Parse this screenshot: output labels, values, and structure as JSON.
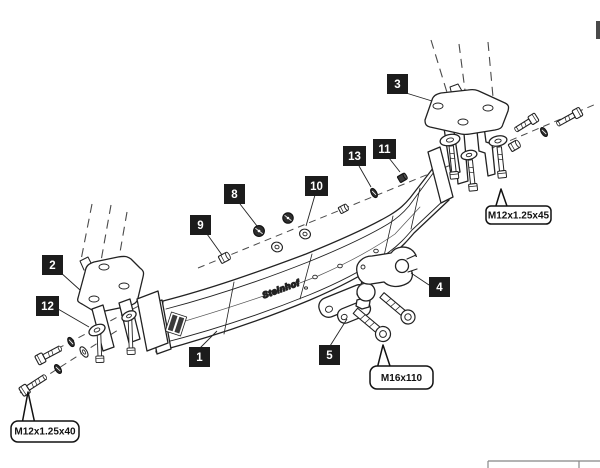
{
  "diagram": {
    "kind": "towbar-exploded-assembly-drawing",
    "beam_logo": "Steinhof",
    "part_labels": [
      {
        "number": "1"
      },
      {
        "number": "2"
      },
      {
        "number": "3"
      },
      {
        "number": "4"
      },
      {
        "number": "5"
      },
      {
        "number": "8"
      },
      {
        "number": "9"
      },
      {
        "number": "10"
      },
      {
        "number": "11"
      },
      {
        "number": "12"
      },
      {
        "number": "13"
      }
    ],
    "callouts": [
      {
        "text": "M12x1.25x45"
      },
      {
        "text": "M16x110"
      },
      {
        "text": "M12x1.25x40"
      }
    ],
    "colors": {
      "line": "#222222",
      "label_bg": "#1c1c1c",
      "label_text": "#ffffff"
    }
  }
}
